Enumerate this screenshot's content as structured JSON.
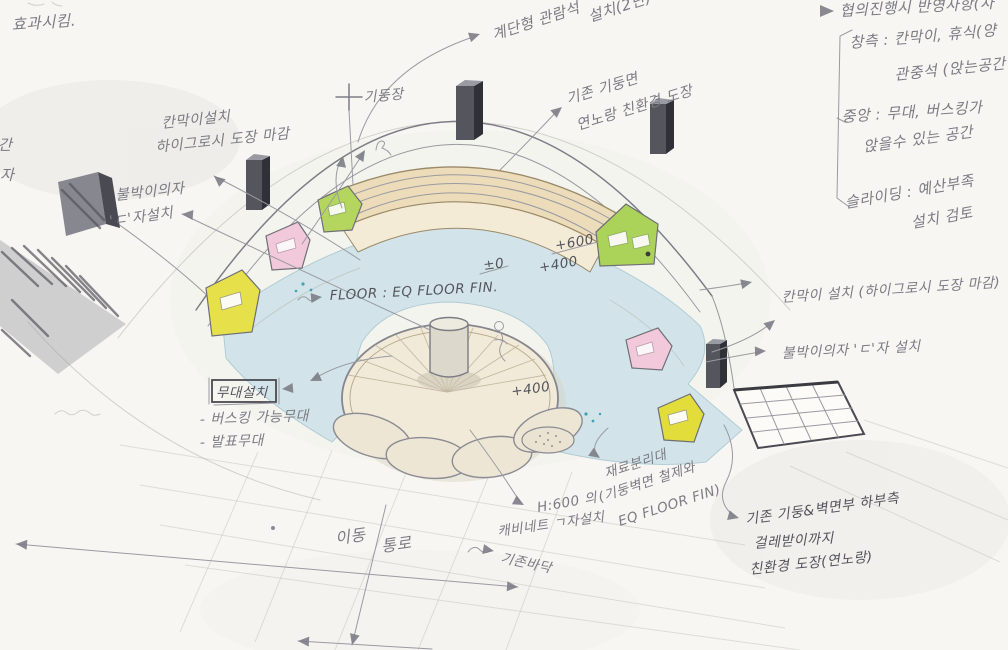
{
  "palette": {
    "paper": "#f7f6f2",
    "pencil": "#7d7d87",
    "pencil_dark": "#3f3f47",
    "floor_blue": "#cfe3e9",
    "wood": "#ecdcba",
    "panel_yellow": "#e6e04a",
    "panel_green": "#aed35b",
    "panel_pink": "#f1c9db",
    "stage_cream": "#f1ead9"
  },
  "ann": {
    "top_left": "효과시킴.",
    "left_cut": [
      "간",
      "자"
    ],
    "partition_left": [
      "칸막이설치",
      "하이그로시 도장 마감"
    ],
    "builtin_left": [
      "불박이의자",
      "'ㄷ'자설치"
    ],
    "column_top": "기둥장",
    "stair": [
      "계단형 관람석",
      "설치(2단)"
    ],
    "column_paint": [
      "기존 기둥면",
      "연노랑 친환경 도장"
    ],
    "floor_label": "FLOOR : EQ FLOOR FIN.",
    "levels": {
      "bench_top": "+600",
      "bench_mid": "+400",
      "ground": "±0",
      "stage": "+400"
    },
    "stage_box": {
      "title": "무대설치",
      "items": [
        "- 버스킹 가능무대",
        "- 발표무대"
      ]
    },
    "partition_right": "칸막이 설치 (하이그로시 도장 마감)",
    "builtin_right": "불박이의자 'ㄷ'자 설치",
    "separator": [
      "재료분리대",
      "(기둥벽면 철제와",
      "EQ FLOOR FIN)"
    ],
    "cabinet": [
      "H:600 의",
      "캐비네트 ㄱ자설치"
    ],
    "corridor": [
      "이동",
      "통로"
    ],
    "existing_floor": "기존바닥",
    "pillar_paint": [
      "기존 기둥&벽면부 하부측",
      "걸레받이까지",
      "친환경 도장(연노랑)"
    ]
  },
  "right_panel": {
    "header": "협의진행시 반영사항(차",
    "items": [
      {
        "lines": [
          "창측 : 칸막이, 휴식(양",
          "관중석 (앉는공간"
        ]
      },
      {
        "lines": [
          "중앙 : 무대, 버스킹가",
          "앉을수 있는 공간"
        ]
      },
      {
        "lines": [
          "슬라이딩 : 예산부족",
          "설치 검토"
        ]
      }
    ]
  }
}
